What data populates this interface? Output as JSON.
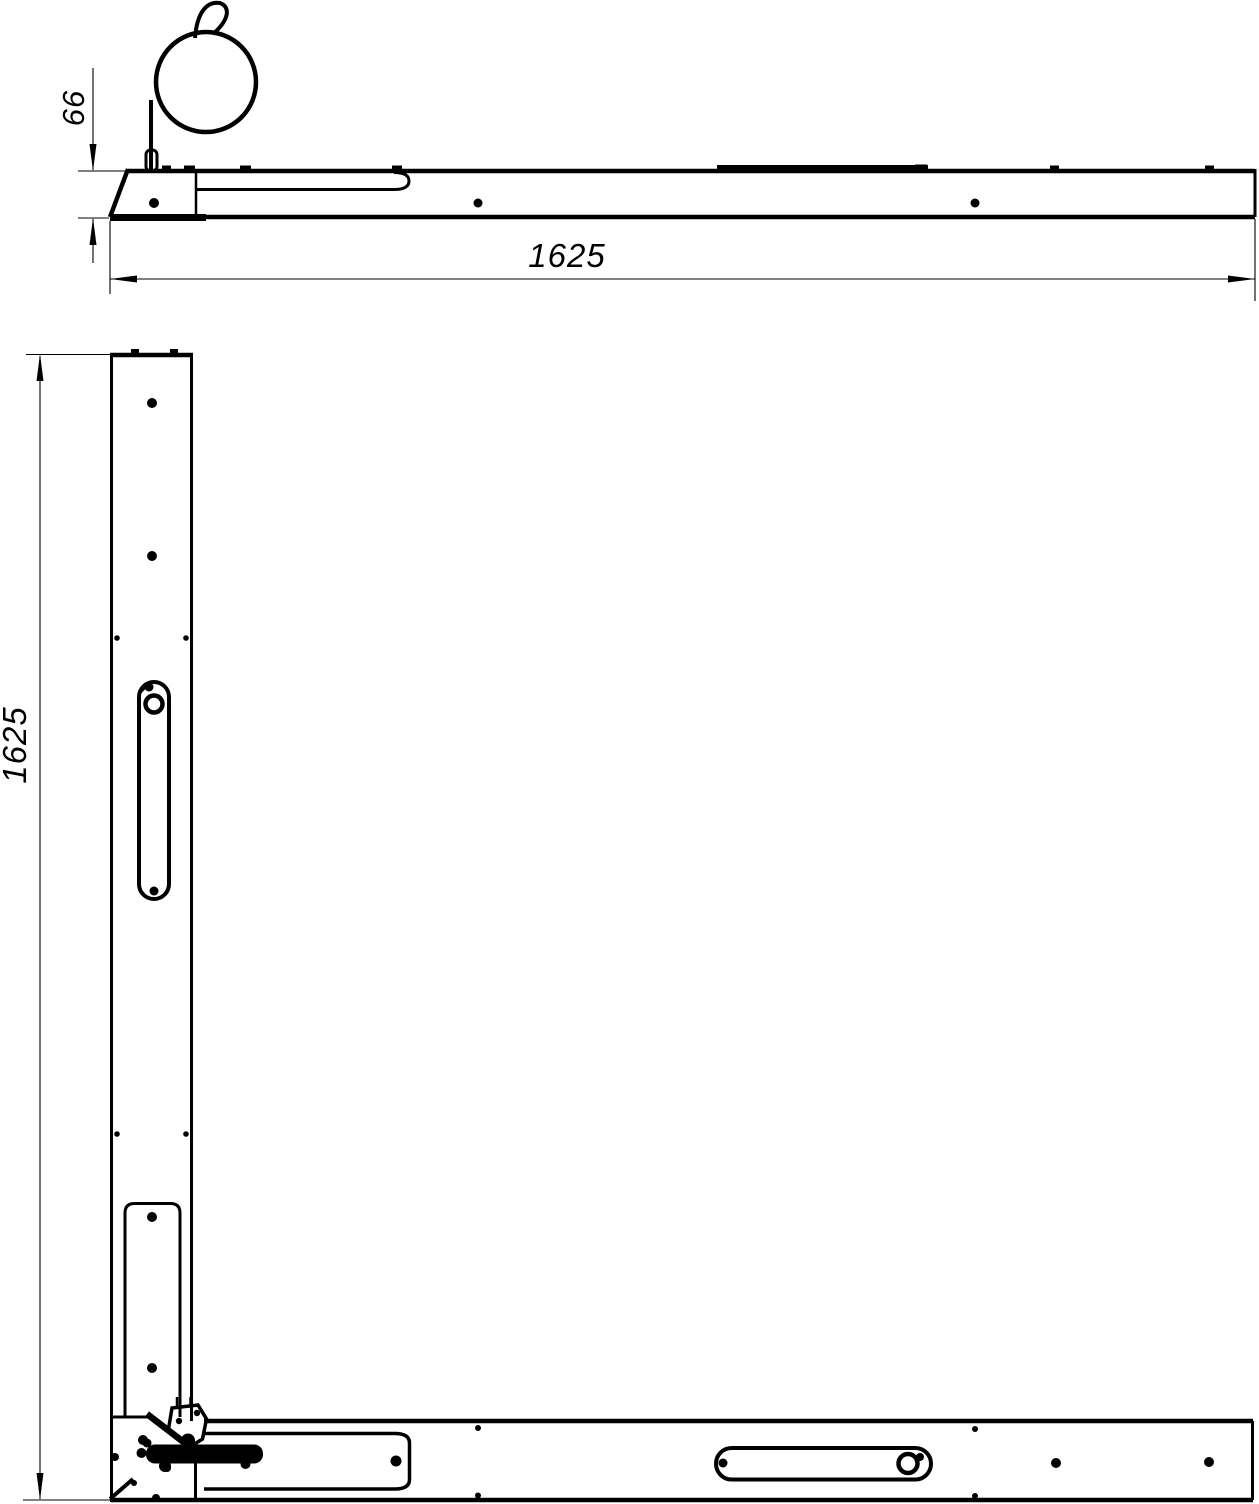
{
  "drawing": {
    "type": "technical-drawing",
    "background_color": "#ffffff",
    "line_color": "#000000",
    "side_view": {
      "height_dim": "66",
      "length_dim": "1625"
    },
    "plan_view": {
      "height_dim": "1625"
    }
  }
}
